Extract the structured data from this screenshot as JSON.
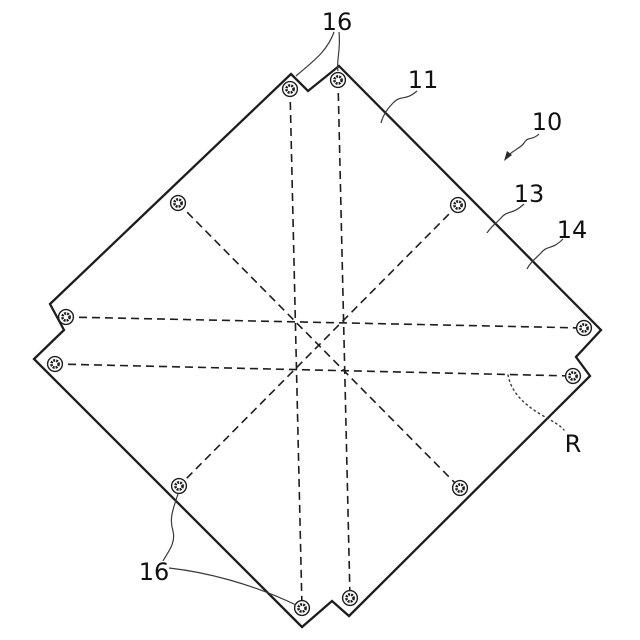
{
  "diagram": {
    "background_color": "#ffffff",
    "stroke_color": "#1d1d1d",
    "plate": {
      "outline_points": "291,74 308,91 339,66 601,330 576,357 590,376 349,616 332,601 302,627 34,359 64,330 50,304"
    },
    "center_lines": [
      {
        "name": "vertical-left",
        "x1": 290,
        "y1": 89,
        "x2": 302,
        "y2": 608
      },
      {
        "name": "vertical-right",
        "x1": 338,
        "y1": 80,
        "x2": 350,
        "y2": 598
      },
      {
        "name": "horizontal-upper",
        "x1": 66,
        "y1": 317,
        "x2": 584,
        "y2": 328
      },
      {
        "name": "horizontal-lower",
        "x1": 55,
        "y1": 364,
        "x2": 573,
        "y2": 376
      },
      {
        "name": "diagonal-tl-br",
        "x1": 178,
        "y1": 203,
        "x2": 460,
        "y2": 488
      },
      {
        "name": "diagonal-tr-bl",
        "x1": 458,
        "y1": 205,
        "x2": 179,
        "y2": 486
      }
    ],
    "hole_style": {
      "outer_r": 7.4,
      "inner_r": 3.6
    },
    "holes": [
      {
        "name": "hole-top-notch-left",
        "cx": 290,
        "cy": 89
      },
      {
        "name": "hole-top-notch-right",
        "cx": 338,
        "cy": 80
      },
      {
        "name": "hole-left-notch-upper",
        "cx": 66,
        "cy": 317
      },
      {
        "name": "hole-left-notch-lower",
        "cx": 55,
        "cy": 364
      },
      {
        "name": "hole-right-notch-upper",
        "cx": 584,
        "cy": 328
      },
      {
        "name": "hole-right-notch-lower",
        "cx": 573,
        "cy": 376
      },
      {
        "name": "hole-bottom-notch-left",
        "cx": 302,
        "cy": 608
      },
      {
        "name": "hole-bottom-notch-right",
        "cx": 350,
        "cy": 598
      },
      {
        "name": "hole-interior-top-left",
        "cx": 178,
        "cy": 203
      },
      {
        "name": "hole-interior-top-right",
        "cx": 458,
        "cy": 205
      },
      {
        "name": "hole-interior-bottom-left",
        "cx": 179,
        "cy": 486
      },
      {
        "name": "hole-interior-bottom-right",
        "cx": 460,
        "cy": 488
      }
    ],
    "labels": [
      {
        "name": "label-16-top",
        "text": "16",
        "x": 337,
        "y": 30
      },
      {
        "name": "label-11",
        "text": "11",
        "x": 423,
        "y": 88
      },
      {
        "name": "label-10",
        "text": "10",
        "x": 547,
        "y": 130
      },
      {
        "name": "label-13",
        "text": "13",
        "x": 529,
        "y": 202
      },
      {
        "name": "label-14",
        "text": "14",
        "x": 572,
        "y": 238
      },
      {
        "name": "label-R",
        "text": "R",
        "x": 573,
        "y": 452
      },
      {
        "name": "label-16-bottom",
        "text": "16",
        "x": 154,
        "y": 580
      }
    ],
    "leaders": [
      {
        "name": "leader-16-top-to-left-hole",
        "path": "M334,32 C327,52 312,62 296,76",
        "style": "solid"
      },
      {
        "name": "leader-16-top-to-right-hole",
        "path": "M339,32 C341,50 336,62 338,71",
        "style": "solid"
      },
      {
        "name": "leader-11",
        "path": "M417,91 C404,102 402,94 393,103 C388,108 383,115 381,123",
        "style": "solid"
      },
      {
        "name": "leader-10-arrow",
        "path": "M539,134 C532,141 528,136 524,143 C520,149 512,150 506,158",
        "style": "solid"
      },
      {
        "name": "leader-13",
        "path": "M524,204 C511,216 508,209 500,219 C494,225 490,228 487,233",
        "style": "solid"
      },
      {
        "name": "leader-14",
        "path": "M563,239 C551,251 548,244 540,254 C534,260 530,263 527,269",
        "style": "solid"
      },
      {
        "name": "leader-R",
        "path": "M508,375 C511,391 522,403 540,414 C552,421 560,425 564,430",
        "style": "dotted"
      },
      {
        "name": "leader-16-bottom-to-interior-hole",
        "path": "M178,494 C173,509 169,519 173,531 C176,543 168,552 163,561",
        "style": "solid"
      },
      {
        "name": "leader-16-bottom-to-notch-hole",
        "path": "M169,568 C205,572 250,583 296,605",
        "style": "solid"
      }
    ],
    "arrowhead_points": "504,161 512,155 507,151"
  }
}
